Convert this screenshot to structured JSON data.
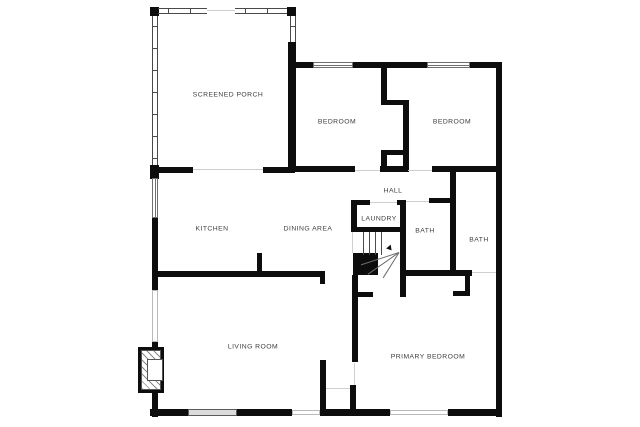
{
  "meta": {
    "title": "Floor plan",
    "background": "#ffffff",
    "wall_color": "#0d0d0d",
    "label_color": "#3d3d3d"
  },
  "rooms": [
    {
      "id": "screened-porch",
      "label": "SCREENED PORCH",
      "x": 228,
      "y": 95
    },
    {
      "id": "bedroom-left",
      "label": "BEDROOM",
      "x": 337,
      "y": 122
    },
    {
      "id": "bedroom-right",
      "label": "BEDROOM",
      "x": 452,
      "y": 122
    },
    {
      "id": "hall",
      "label": "HALL",
      "x": 393,
      "y": 191
    },
    {
      "id": "kitchen",
      "label": "KITCHEN",
      "x": 212,
      "y": 229
    },
    {
      "id": "dining-area",
      "label": "DINING AREA",
      "x": 308,
      "y": 229
    },
    {
      "id": "laundry",
      "label": "LAUNDRY",
      "x": 379,
      "y": 219
    },
    {
      "id": "bath-left",
      "label": "BATH",
      "x": 425,
      "y": 231
    },
    {
      "id": "bath-right",
      "label": "BATH",
      "x": 479,
      "y": 240
    },
    {
      "id": "living-room",
      "label": "LIVING ROOM",
      "x": 253,
      "y": 347
    },
    {
      "id": "primary-bedroom",
      "label": "PRIMARY BEDROOM",
      "x": 428,
      "y": 357
    }
  ],
  "walls": [
    {
      "n": "porch-corner-tl",
      "r": [
        150,
        7,
        9,
        9
      ]
    },
    {
      "n": "porch-corner-tr",
      "r": [
        287,
        7,
        9,
        9
      ]
    },
    {
      "n": "porch-right-wall",
      "r": [
        288,
        42,
        8,
        126
      ]
    },
    {
      "n": "bedroom-top-wall-a",
      "r": [
        293,
        62,
        20,
        6
      ]
    },
    {
      "n": "bedroom-top-wall-b",
      "r": [
        353,
        62,
        74,
        6
      ]
    },
    {
      "n": "bedroom-top-wall-c",
      "r": [
        470,
        62,
        32,
        6
      ]
    },
    {
      "n": "right-exterior-wall",
      "r": [
        496,
        62,
        6,
        355
      ]
    },
    {
      "n": "bedroom-bottom-wall-a",
      "r": [
        290,
        166,
        65,
        6
      ]
    },
    {
      "n": "bedroom-bottom-wall-b",
      "r": [
        380,
        166,
        28,
        6
      ]
    },
    {
      "n": "bedroom-bottom-wall-c",
      "r": [
        432,
        166,
        70,
        6
      ]
    },
    {
      "n": "closet-wall-a-upper",
      "r": [
        381,
        66,
        6,
        39
      ]
    },
    {
      "n": "closet-shelf-1",
      "r": [
        381,
        100,
        28,
        5
      ]
    },
    {
      "n": "closet-wall-b",
      "r": [
        403,
        100,
        6,
        72
      ]
    },
    {
      "n": "closet-shelf-2",
      "r": [
        381,
        150,
        28,
        5
      ]
    },
    {
      "n": "closet-wall-a-lower",
      "r": [
        381,
        150,
        6,
        22
      ]
    },
    {
      "n": "porch-bottom-corner",
      "r": [
        150,
        165,
        9,
        14
      ]
    },
    {
      "n": "porch-bottom-wall-a",
      "r": [
        158,
        167,
        35,
        6
      ]
    },
    {
      "n": "porch-bottom-wall-b",
      "r": [
        263,
        167,
        32,
        6
      ]
    },
    {
      "n": "left-wall-mid",
      "r": [
        152,
        218,
        6,
        72
      ]
    },
    {
      "n": "left-wall-lower-a",
      "r": [
        152,
        342,
        6,
        10
      ]
    },
    {
      "n": "left-wall-lower-b",
      "r": [
        152,
        390,
        6,
        27
      ]
    },
    {
      "n": "bottom-wall-a",
      "r": [
        150,
        409,
        38,
        7
      ]
    },
    {
      "n": "bottom-wall-b",
      "r": [
        237,
        409,
        55,
        7
      ]
    },
    {
      "n": "bottom-wall-c",
      "r": [
        320,
        409,
        70,
        7
      ]
    },
    {
      "n": "bottom-wall-d",
      "r": [
        448,
        409,
        54,
        7
      ]
    },
    {
      "n": "kitchen-living-wall",
      "r": [
        158,
        271,
        167,
        6
      ]
    },
    {
      "n": "kitchen-wall-stub",
      "r": [
        320,
        277,
        5,
        7
      ]
    },
    {
      "n": "kitchen-peninsula",
      "r": [
        257,
        253,
        5,
        18
      ]
    },
    {
      "n": "laundry-left-wall",
      "r": [
        351,
        200,
        6,
        32
      ]
    },
    {
      "n": "laundry-top-wall",
      "r": [
        351,
        200,
        19,
        5
      ]
    },
    {
      "n": "laundry-top-corner",
      "r": [
        397,
        200,
        9,
        5
      ]
    },
    {
      "n": "laundry-right-wall",
      "r": [
        400,
        200,
        6,
        97
      ]
    },
    {
      "n": "laundry-bottom-wall",
      "r": [
        351,
        227,
        52,
        5
      ]
    },
    {
      "n": "living-primary-wall",
      "r": [
        352,
        275,
        6,
        87
      ]
    },
    {
      "n": "living-primary-stub",
      "r": [
        358,
        292,
        15,
        5
      ]
    },
    {
      "n": "vestibule-left-wall",
      "r": [
        320,
        360,
        6,
        52
      ]
    },
    {
      "n": "vestibule-right-wall",
      "r": [
        350,
        385,
        6,
        26
      ]
    },
    {
      "n": "bath-divider-wall",
      "r": [
        450,
        172,
        6,
        100
      ]
    },
    {
      "n": "bath-left-top-wall",
      "r": [
        429,
        198,
        27,
        5
      ]
    },
    {
      "n": "bath-bottom-wall",
      "r": [
        406,
        270,
        66,
        6
      ]
    },
    {
      "n": "closet-jog-vertical",
      "r": [
        465,
        276,
        5,
        20
      ]
    },
    {
      "n": "closet-jog-horizontal",
      "r": [
        453,
        291,
        17,
        5
      ]
    }
  ],
  "chimney": {
    "n": "chimney-block",
    "r": [
      353,
      253,
      25,
      22
    ]
  },
  "screens": [
    {
      "n": "porch-screen-top-left",
      "dir": "h",
      "r": [
        158,
        8,
        49,
        6
      ]
    },
    {
      "n": "porch-screen-top-right",
      "dir": "h",
      "r": [
        235,
        8,
        52,
        6
      ]
    },
    {
      "n": "porch-screen-left",
      "dir": "v",
      "r": [
        152,
        16,
        6,
        149
      ]
    },
    {
      "n": "porch-screen-right",
      "dir": "v",
      "r": [
        290,
        16,
        6,
        26
      ]
    }
  ],
  "windows": [
    {
      "n": "bedroom-left-window",
      "style": "double",
      "vert": false,
      "r": [
        313,
        62,
        40,
        6
      ]
    },
    {
      "n": "bedroom-right-window",
      "style": "double",
      "vert": false,
      "r": [
        427,
        62,
        43,
        6
      ]
    },
    {
      "n": "kitchen-left-window",
      "style": "double",
      "vert": true,
      "r": [
        152,
        178,
        6,
        40
      ]
    },
    {
      "n": "living-left-window",
      "style": "plain",
      "vert": true,
      "r": [
        152,
        290,
        6,
        52
      ]
    },
    {
      "n": "living-bottom-window",
      "style": "gray",
      "vert": false,
      "r": [
        188,
        409,
        49,
        7
      ]
    },
    {
      "n": "bottom-window-small",
      "style": "plain",
      "vert": false,
      "r": [
        292,
        410,
        28,
        5
      ]
    },
    {
      "n": "primary-bottom-window",
      "style": "plain",
      "vert": false,
      "r": [
        390,
        410,
        58,
        5
      ]
    }
  ],
  "openings": [
    {
      "n": "porch-kitchen-opening",
      "r": [
        193,
        169,
        70,
        1
      ]
    },
    {
      "n": "porch-top-gap",
      "r": [
        207,
        10,
        28,
        1
      ]
    },
    {
      "n": "hall-bedroom-opening",
      "r": [
        355,
        170,
        25,
        1
      ]
    },
    {
      "n": "bedroom-right-door",
      "r": [
        408,
        170,
        24,
        1
      ]
    },
    {
      "n": "laundry-door",
      "r": [
        370,
        202,
        27,
        1
      ]
    },
    {
      "n": "bath-left-door",
      "r": [
        406,
        201,
        23,
        1
      ]
    },
    {
      "n": "basement-stair-opening",
      "r": [
        352,
        232,
        1,
        21
      ]
    },
    {
      "n": "primary-bedroom-door",
      "r": [
        354,
        363,
        1,
        22
      ]
    },
    {
      "n": "vestibule-threshold",
      "r": [
        326,
        388,
        24,
        1
      ]
    },
    {
      "n": "bath-right-entry",
      "r": [
        472,
        272,
        24,
        1
      ]
    }
  ],
  "stairs": {
    "n": "staircase",
    "r": [
      357,
      232,
      44,
      23
    ],
    "treads": [
      6,
      12,
      18,
      24
    ],
    "winders": [
      {
        "len": 40,
        "deg": -18
      },
      {
        "len": 38,
        "deg": -35
      },
      {
        "len": 30,
        "deg": -58
      }
    ],
    "arrow": {
      "x": 30,
      "y": 14
    }
  },
  "fireplace": {
    "outer": {
      "n": "fireplace-surround",
      "r": [
        138,
        347,
        26,
        46
      ]
    },
    "hatch": {
      "n": "fireplace-masonry",
      "r": [
        141,
        350,
        20,
        40
      ]
    },
    "box": {
      "n": "fireplace-firebox",
      "r": [
        147,
        359,
        16,
        22
      ]
    }
  }
}
